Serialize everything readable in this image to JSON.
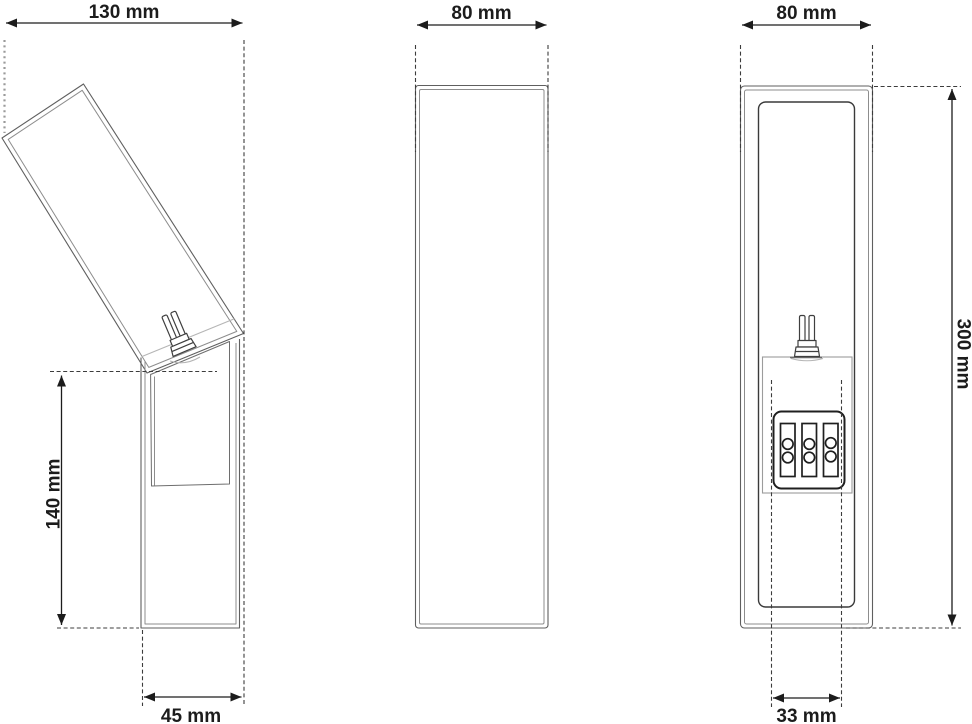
{
  "drawing": {
    "kind": "technical-3-view-dimension-drawing",
    "subject": "angled wall lamp",
    "views": {
      "side": "side-view-angled-head",
      "front": "front-view",
      "rear": "rear-view-with-terminal-block"
    },
    "dimensions": {
      "head_width": "130 mm",
      "front_width": "80 mm",
      "rear_width": "80 mm",
      "lower_body_height": "140 mm",
      "overall_height": "300 mm",
      "base_depth": "45 mm",
      "mount_slot_width": "33 mm"
    },
    "colors": {
      "background": "#ffffff",
      "outline": "#5f5f5f",
      "outline_light": "#8d8d8d",
      "outline_dark": "#3a3a3a",
      "outline_faint": "#b5b5b5",
      "terminal_block": "#1f1f1f",
      "dimension_line": "#1c1c1c",
      "extension_dash": "#3c3c3c",
      "extension_dot_gray": "#9a9a9a"
    }
  }
}
